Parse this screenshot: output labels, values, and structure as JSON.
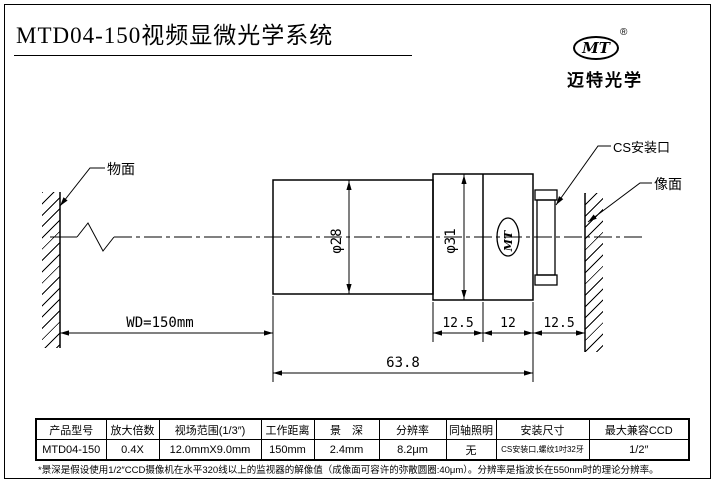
{
  "page": {
    "title": "MTD04-150视频显微光学系统",
    "footnote": "*景深是假设使用1/2″CCD摄像机在水平320线以上的监视器的解像值（成像面可容许的弥散圆圈:40μm）。分辨率是指波长在550nm时的理论分辨率。"
  },
  "logo": {
    "mark": "MT",
    "registered": "®",
    "company": "迈特光学"
  },
  "drawing": {
    "object_plane_label": "物面",
    "image_plane_label": "像面",
    "cs_mount_label": "CS安装口",
    "working_distance": "WD=150mm",
    "dia_front": "φ28",
    "dia_rear": "φ31",
    "barrel_mark": "MT",
    "seg_front": "12.5",
    "seg_mid": "12",
    "seg_rear": "12.5",
    "total_length": "63.8"
  },
  "table": {
    "headers": [
      "产品型号",
      "放大倍数",
      "视场范围(1/3″)",
      "工作距离",
      "景　深",
      "分辨率",
      "同轴照明",
      "安装尺寸",
      "最大兼容CCD"
    ],
    "row": [
      "MTD04-150",
      "0.4X",
      "12.0mmX9.0mm",
      "150mm",
      "2.4mm",
      "8.2μm",
      "无",
      "CS安装口,螺纹1吋32牙",
      "1/2″"
    ]
  }
}
